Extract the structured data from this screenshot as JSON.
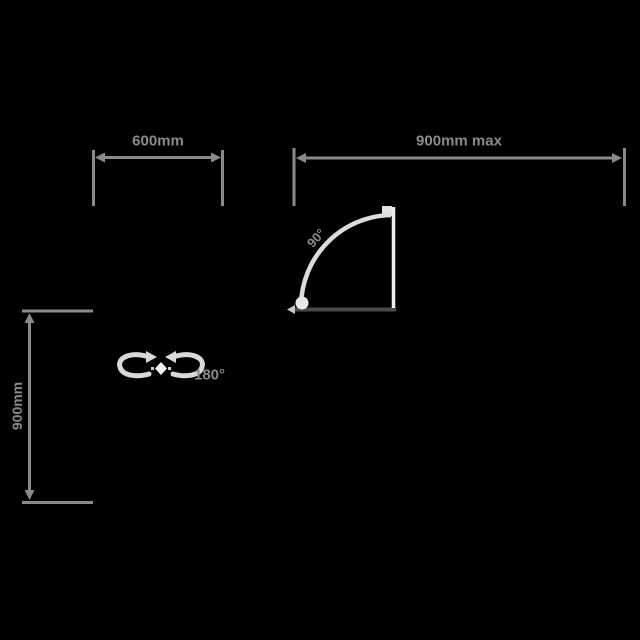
{
  "diagram": {
    "title": "door-swing-dimension-diagram",
    "background_color": "#000000",
    "palette": {
      "dimension_gray": "#8a8a8a",
      "text_gray": "#8a8a8a",
      "light_gray": "#dcdcdc",
      "bright_gray": "#ebebeb",
      "wall_dark_gray": "#4a4a4a"
    },
    "dimensions": {
      "top_left": {
        "label": "600mm"
      },
      "top_right": {
        "label": "900mm max"
      },
      "left_vertical": {
        "label": "900mm"
      }
    },
    "door": {
      "swing_angle_label": "90°"
    },
    "rotation": {
      "label": "180°"
    }
  }
}
